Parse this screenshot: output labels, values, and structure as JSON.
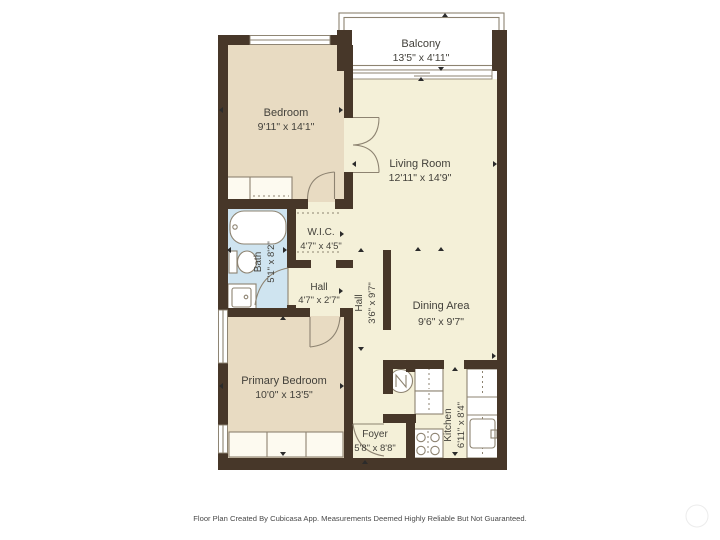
{
  "plan": {
    "title": "Floor Plan",
    "rooms": [
      {
        "id": "balcony",
        "name": "Balcony",
        "dims": "13'5\" x 4'11\""
      },
      {
        "id": "bedroom",
        "name": "Bedroom",
        "dims": "9'11\" x 14'1\""
      },
      {
        "id": "living_room",
        "name": "Living Room",
        "dims": "12'11\" x 14'9\""
      },
      {
        "id": "wic",
        "name": "W.I.C.",
        "dims": "4'7\" x 4'5\""
      },
      {
        "id": "bath",
        "name": "Bath",
        "dims": "5'1\" x 8'2\""
      },
      {
        "id": "hall_small",
        "name": "Hall",
        "dims": "4'7\" x 2'7\""
      },
      {
        "id": "hall",
        "name": "Hall",
        "dims": "3'6\" x 9'7\""
      },
      {
        "id": "dining_area",
        "name": "Dining Area",
        "dims": "9'6\" x 9'7\""
      },
      {
        "id": "primary_bedroom",
        "name": "Primary Bedroom",
        "dims": "10'0\" x 13'5\""
      },
      {
        "id": "foyer",
        "name": "Foyer",
        "dims": "5'8\" x 8'8\""
      },
      {
        "id": "kitchen",
        "name": "Kitchen",
        "dims": "6'11\" x 8'4\""
      }
    ],
    "footer": "Floor Plan Created By Cubicasa App. Measurements Deemed Highly Reliable But Not Guaranteed.",
    "colors": {
      "wall": "#473729",
      "room_tan": "#e8dbc2",
      "room_cream": "#f4f0d8",
      "room_blue": "#cfe4f0",
      "fixture_outline": "#8d8371",
      "label_text": "#43413b",
      "footer_text": "#4a4a4a",
      "marker": "#2b2b2b"
    }
  }
}
